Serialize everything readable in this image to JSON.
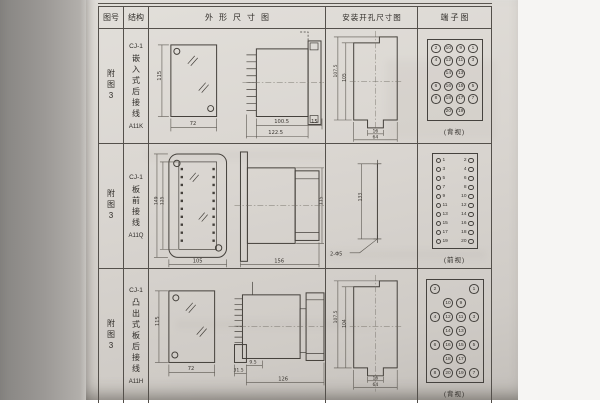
{
  "colors": {
    "paper": "#d9d5d0",
    "table_line": "#54504b",
    "ink": "#2f2c28"
  },
  "table": {
    "headers": {
      "fig": "图号",
      "struct": "结构",
      "outline": "外形尺寸图",
      "mount": "安装开孔尺寸图",
      "terminal": "端子图"
    },
    "rows": [
      {
        "fig_label": "附图3",
        "model": "CJ-1",
        "structure": "嵌入式后接线",
        "code": "A11K",
        "outline_dims": {
          "height": "115",
          "width": "72",
          "body_len": "100.5",
          "total_len": "122.5",
          "flange": "15"
        },
        "mount_dims": {
          "h_outer": "107.5",
          "h_inner": "105",
          "w_slot": "16",
          "w_outer": "64"
        },
        "terminal": {
          "view_label": "(背视)",
          "grid": [
            [
              "2",
              "10",
              "9",
              "1"
            ],
            [
              "4",
              "12",
              "11",
              "3"
            ],
            [
              "",
              "14",
              "13",
              ""
            ],
            [
              "6",
              "16",
              "15",
              "5"
            ],
            [
              "8",
              "18",
              "17",
              "7"
            ],
            [
              "",
              "20",
              "19",
              ""
            ]
          ]
        }
      },
      {
        "fig_label": "附图3",
        "model": "CJ-1",
        "structure": "板前接线",
        "code": "A11Q",
        "outline_dims": {
          "h_outer": "149",
          "h_inner": "125",
          "width": "105",
          "length": "156",
          "height": "115"
        },
        "mount_dims": {
          "spacing": "133",
          "holes": "2-Φ5"
        },
        "terminal": {
          "view_label": "(前视)",
          "left": [
            "1",
            "3",
            "5",
            "7",
            "9",
            "11",
            "13",
            "15",
            "17",
            "19"
          ],
          "right": [
            "2",
            "4",
            "6",
            "8",
            "10",
            "12",
            "14",
            "16",
            "18",
            "20"
          ]
        }
      },
      {
        "fig_label": "附图3",
        "model": "CJ-1",
        "structure": "凸出式板后接线",
        "code": "A11H",
        "outline_dims": {
          "height": "115",
          "width": "72",
          "d1": "31.5",
          "d2": "9.5",
          "length": "126"
        },
        "mount_dims": {
          "h_outer": "107.5",
          "h_inner": "104",
          "w_slot": "16",
          "w_outer": "64"
        },
        "terminal": {
          "view_label": "(背视)",
          "grid": [
            [
              "2",
              "",
              "",
              "1"
            ],
            [
              "",
              "10",
              "9",
              ""
            ],
            [
              "4",
              "12",
              "11",
              "3"
            ],
            [
              "",
              "14",
              "13",
              ""
            ],
            [
              "6",
              "16",
              "15",
              "5"
            ],
            [
              "",
              "18",
              "17",
              ""
            ],
            [
              "8",
              "20",
              "19",
              "7"
            ]
          ]
        }
      }
    ]
  }
}
